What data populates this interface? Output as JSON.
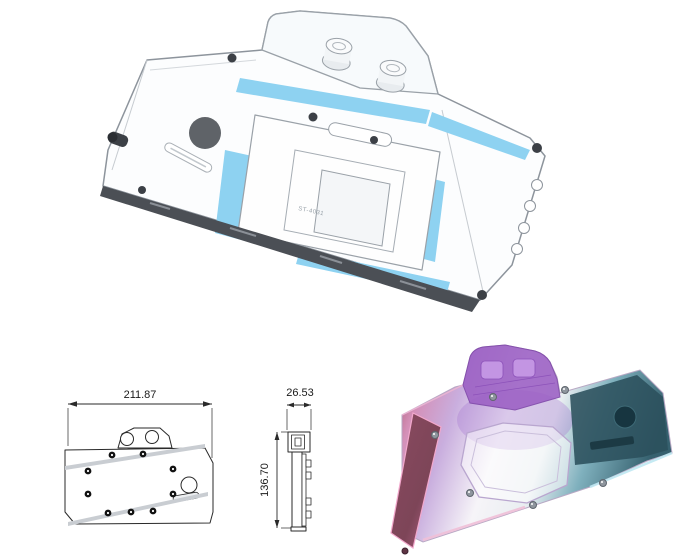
{
  "drawing": {
    "width_label": "211.87",
    "depth_label": "26.53",
    "height_label": "136.70"
  },
  "engraving": {
    "model_code": "ST-4031"
  },
  "colors": {
    "coolant_blue": "#8ed2f1",
    "outline_gray": "#8d949c",
    "badge_gray": "#5f6368",
    "pcb_dark": "#4b4f55",
    "drawing_line": "#2a2a2a",
    "rgb_pink_dark": "#a24f66",
    "rgb_pink": "#d490b8",
    "rgb_lavender": "#c9aede",
    "rgb_white": "#f6f4f8",
    "rgb_teal_light": "#7fb0bd",
    "rgb_teal_dark": "#36616f",
    "rgb_purple": "#9b5fc4",
    "rgb_panel_teal": "#2b505c"
  }
}
